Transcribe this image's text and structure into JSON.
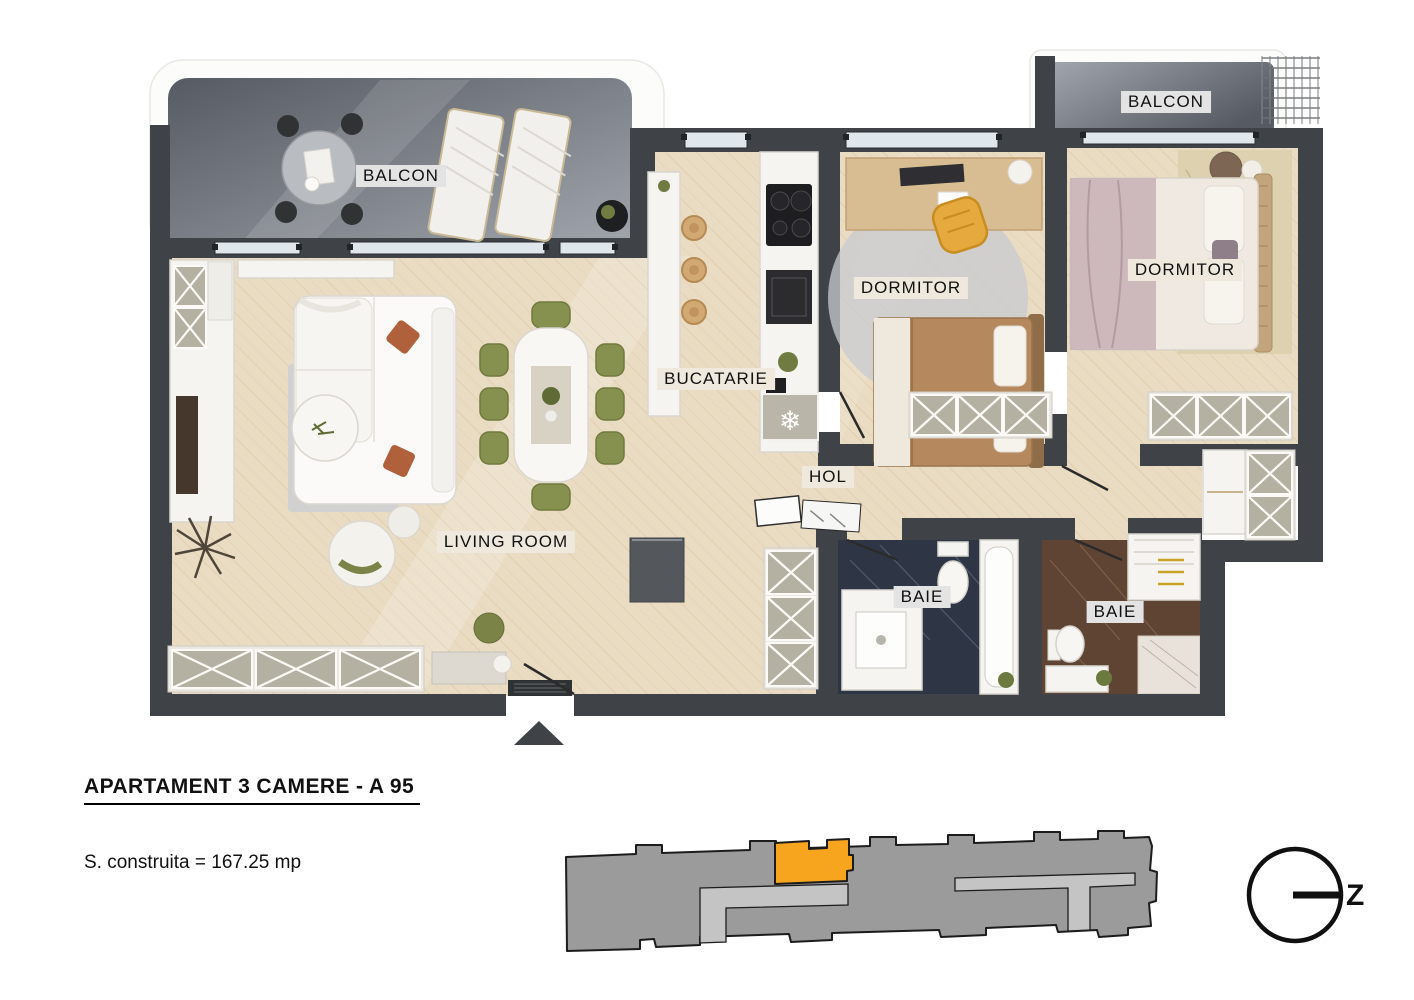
{
  "plan": {
    "title": "APARTAMENT 3 CAMERE  - A 95",
    "area_label": "S. construita = 167.25 mp",
    "rooms": {
      "balcony_left": "BALCON",
      "balcony_right": "BALCON",
      "bedroom_left": "DORMITOR",
      "bedroom_right": "DORMITOR",
      "kitchen": "BUCATARIE",
      "hall": "HOL",
      "living_room": "LIVING ROOM",
      "bathroom_left": "BAIE",
      "bathroom_right": "BAIE"
    },
    "icons": {
      "fridge_snowflake": "❄"
    }
  },
  "compass": {
    "letter": "Z"
  },
  "colors": {
    "wall": "#3F4347",
    "wood_floor": "#EADCC2",
    "wood_grain": "#D8C2A0",
    "balcony_marble_dark": "#565B63",
    "balcony_marble_light": "#A3A7AE",
    "bathroom_left_floor": "#2E3646",
    "bathroom_right_floor": "#5F4433",
    "cabinet_panel": "#B5B1A2",
    "accent_unit": "#F7A51E",
    "site_building": "#9B9B9B",
    "site_corridor": "#C4C4C4",
    "site_outline": "#1C1C1C",
    "text": "#111111",
    "label_bg": "#EFE9DD",
    "label_bg_gray": "#E3E3E3"
  }
}
